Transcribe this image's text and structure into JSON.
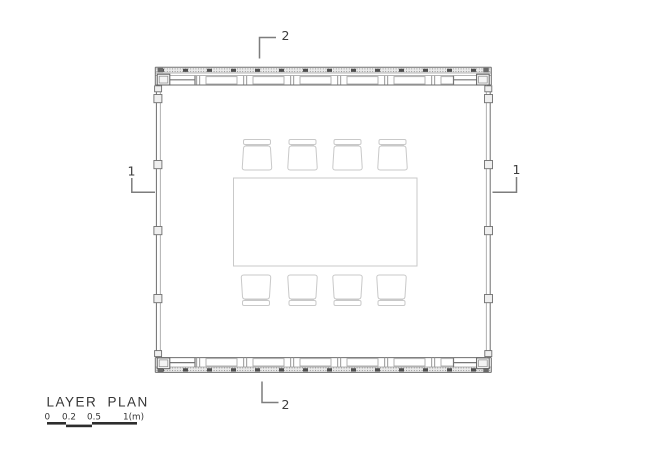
{
  "drawing": {
    "title": "LAYER PLAN",
    "scale_bar": {
      "labels": [
        "0",
        "0.2",
        "0.5",
        "1(m)"
      ]
    },
    "markers": {
      "top": "2",
      "bottom": "2",
      "left": "1",
      "right": "1"
    },
    "furniture": {
      "tables": 1,
      "chairs": 8
    },
    "colors": {
      "background": "#ffffff",
      "wall_line": "#6e6e6e",
      "stipple_dot": "#8f8f8f",
      "tick_dark": "#4f4f4f",
      "furniture_line": "#c9c9c9",
      "text": "#3c3c3c",
      "scale_bar": "#2d2d2d"
    }
  }
}
